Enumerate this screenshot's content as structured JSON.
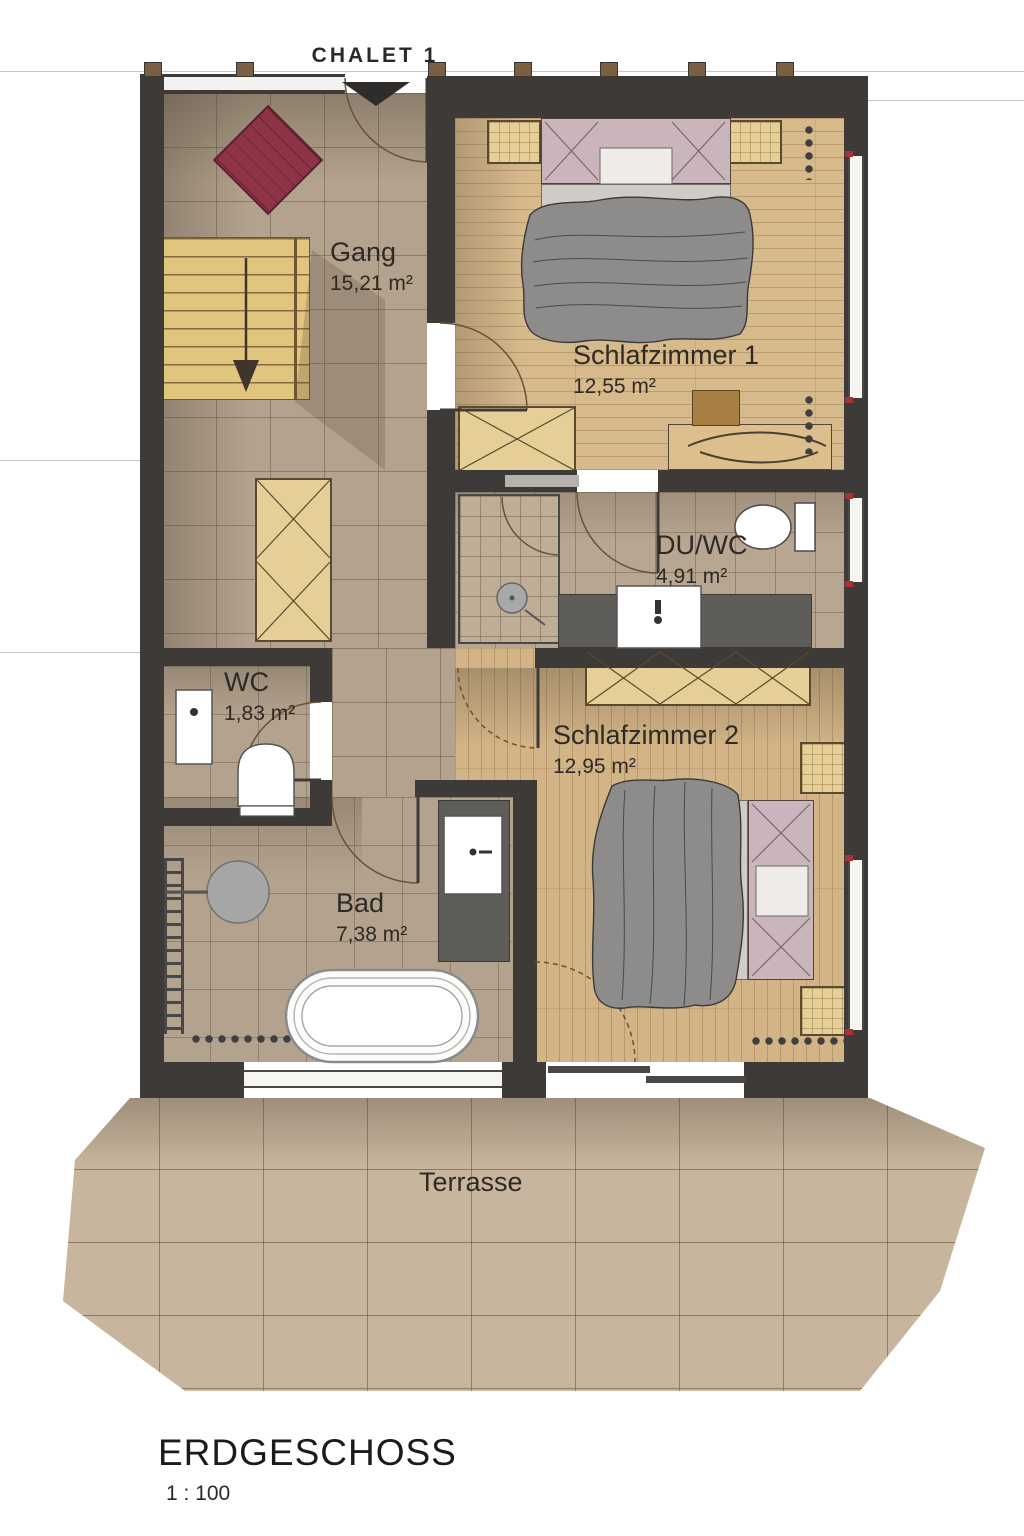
{
  "title": "CHALET 1",
  "rooms": [
    {
      "name": "Gang",
      "area": "15,21 m²"
    },
    {
      "name": "Schlafzimmer 1",
      "area": "12,55 m²"
    },
    {
      "name": "DU/WC",
      "area": "4,91 m²"
    },
    {
      "name": "WC",
      "area": "1,83 m²"
    },
    {
      "name": "Bad",
      "area": "7,38 m²"
    },
    {
      "name": "Schlafzimmer 2",
      "area": "12,95 m²"
    },
    {
      "name": "Terrasse",
      "area": ""
    }
  ],
  "footer": {
    "floor": "ERDGESCHOSS",
    "scale": "1 : 100"
  },
  "colors": {
    "wall": "#3e3a37",
    "tile_floor": "#b3a28e",
    "wood_floor": "#d7ba8c",
    "terrace": "#c7b59d",
    "rug_red": "#8d3547",
    "furniture_wood": "#e6cf96",
    "duvet": "#8e8c8a",
    "headboard": "#c9b5bb",
    "counter": "#5f5d5a"
  }
}
